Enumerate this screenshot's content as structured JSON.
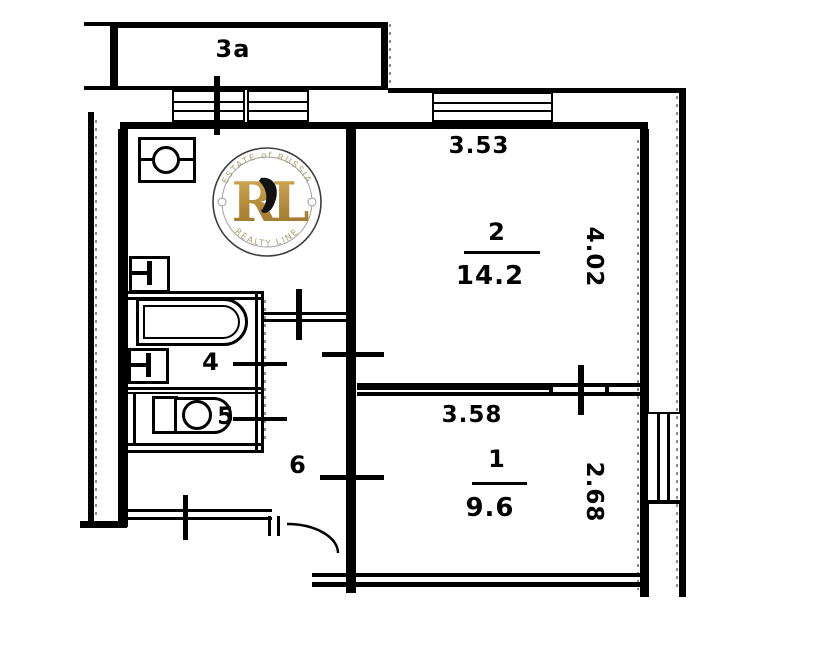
{
  "plan": {
    "balcony": {
      "label": "3a"
    },
    "rooms": {
      "room_2": {
        "number": "2",
        "area": "14.2",
        "dim_top": "3.53",
        "dim_side": "4.02"
      },
      "room_1": {
        "number": "1",
        "area": "9.6",
        "dim_top": "3.58",
        "dim_side": "2.68"
      },
      "room_4": {
        "number": "4"
      },
      "room_5": {
        "number": "5"
      },
      "room_6": {
        "number": "6"
      }
    },
    "line_color": "#000000",
    "background_color": "#ffffff"
  },
  "watermark": {
    "arc_top": "ESTATE of RUSSIA",
    "arc_bottom": "REALTY LINE",
    "monogram": "RL",
    "gold_color": "#b3893a",
    "ring_color": "#3c3c3c",
    "arc_text_color": "#b1a078"
  }
}
